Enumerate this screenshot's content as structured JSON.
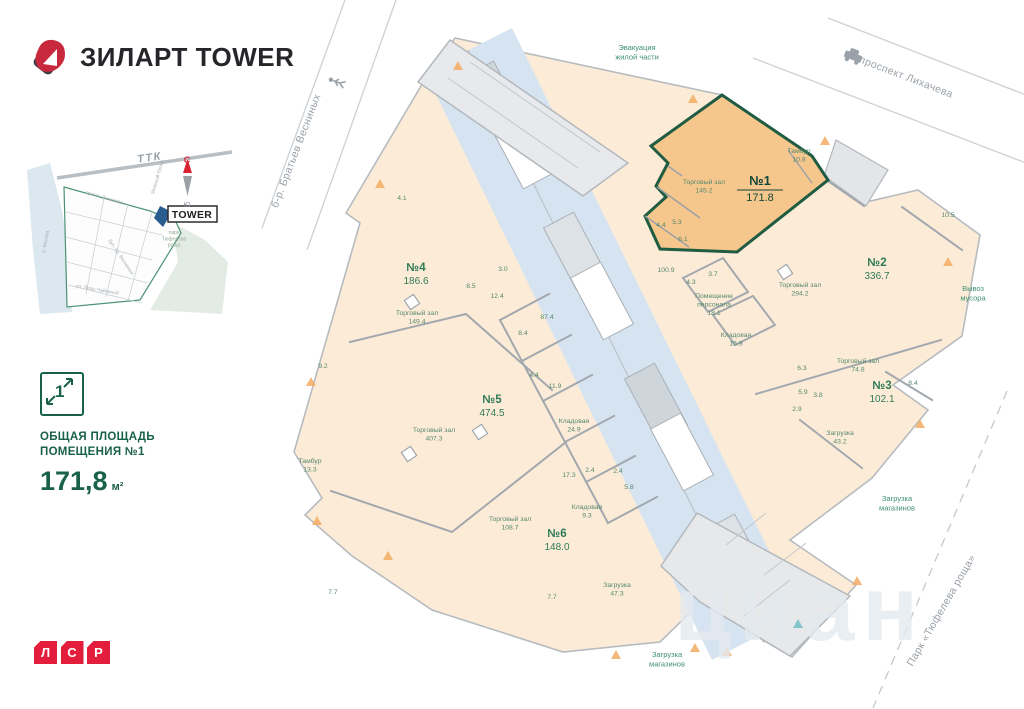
{
  "brand": {
    "logo_text": "ЗИЛАРТ TOWER",
    "developer_letters": [
      "Л",
      "С",
      "Р"
    ]
  },
  "info": {
    "icon_number": "1",
    "title_line1": "ОБЩАЯ ПЛОЩАДЬ",
    "title_line2": "ПОМЕЩЕНИЯ №1",
    "area_value": "171,8",
    "area_unit": "м²"
  },
  "colors": {
    "accent_green": "#1a614c",
    "label_green": "#2e7a57",
    "unit_fill": "#fcecd7",
    "unit1_fill": "#f6c78d",
    "unit1_border": "#1f5c41",
    "core_blue": "#d6e4f1",
    "brand_red": "#e31e3d",
    "compass_red": "#d8232f"
  },
  "watermark": "циан",
  "plan": {
    "labels": [
      {
        "x": 150,
        "y": 161,
        "r": -8,
        "c": "ttk",
        "l": [
          "ТТК"
        ],
        "n": "map-ttk-label"
      },
      {
        "x": 187,
        "y": 163,
        "c": "compass-n",
        "l": [
          "С"
        ],
        "n": "compass-north"
      },
      {
        "x": 187,
        "y": 207,
        "c": "compass-s",
        "l": [
          "Ю"
        ],
        "n": "compass-south"
      },
      {
        "x": 192,
        "y": 218,
        "c": "tower",
        "l": [
          "TOWER"
        ],
        "n": "map-tower-label"
      },
      {
        "x": 47,
        "y": 242,
        "r": -80,
        "c": "map-street",
        "l": [
          "р. Москва"
        ],
        "n": "map-river-label"
      },
      {
        "x": 174,
        "y": 234,
        "c": "map-park",
        "l": [
          "парк",
          "Тюфелева",
          "роща"
        ],
        "n": "map-park-label"
      },
      {
        "x": 104,
        "y": 199,
        "r": 16,
        "c": "map-street",
        "l": [
          "просп. Лихачева"
        ],
        "n": "map-street-label"
      },
      {
        "x": 159,
        "y": 177,
        "r": -74,
        "c": "map-street",
        "l": [
          "Зеленый бульв."
        ],
        "n": "map-street-label"
      },
      {
        "x": 97,
        "y": 291,
        "r": 10,
        "c": "map-street",
        "l": [
          "ул. Лизы Чайкиной"
        ],
        "n": "map-street-label"
      },
      {
        "x": 120,
        "y": 258,
        "r": 56,
        "c": "map-street",
        "l": [
          "бул. бр. Весниных"
        ],
        "n": "map-street-label"
      },
      {
        "x": 905,
        "y": 80,
        "r": 21,
        "c": "street",
        "l": [
          "проспект Лихачева"
        ],
        "n": "street-label"
      },
      {
        "x": 299,
        "y": 152,
        "r": -69,
        "c": "street",
        "l": [
          "б-р. Братьев Весниных"
        ],
        "n": "street-label"
      },
      {
        "x": 944,
        "y": 612,
        "r": -60,
        "c": "street",
        "l": [
          "Парк «Тюфелева роща»"
        ],
        "n": "park-label"
      },
      {
        "x": 637,
        "y": 50,
        "c": "annot",
        "l": [
          "Эвакуация",
          "жилой части"
        ],
        "n": "annotation"
      },
      {
        "x": 973,
        "y": 291,
        "c": "annot",
        "l": [
          "Вывоз",
          "мусора"
        ],
        "n": "annotation"
      },
      {
        "x": 897,
        "y": 501,
        "c": "annot",
        "l": [
          "Загрузка",
          "магазинов"
        ],
        "n": "annotation"
      },
      {
        "x": 667,
        "y": 657,
        "c": "annot",
        "l": [
          "Загрузка",
          "магазинов"
        ],
        "n": "annotation"
      },
      {
        "x": 760,
        "y": 185,
        "c": "unit1",
        "l": [
          "№1"
        ],
        "n": "unit1-number"
      },
      {
        "x": 760,
        "y": 201,
        "c": "u1area",
        "l": [
          "171.8"
        ],
        "n": "unit1-area"
      },
      {
        "x": 416,
        "y": 271,
        "c": "unit",
        "l": [
          "№4"
        ],
        "n": "unit-number"
      },
      {
        "x": 416,
        "y": 284,
        "c": "uarea",
        "l": [
          "186.6"
        ],
        "n": "unit-area"
      },
      {
        "x": 492,
        "y": 403,
        "c": "unit",
        "l": [
          "№5"
        ],
        "n": "unit-number"
      },
      {
        "x": 492,
        "y": 416,
        "c": "uarea",
        "l": [
          "474.5"
        ],
        "n": "unit-area"
      },
      {
        "x": 557,
        "y": 537,
        "c": "unit",
        "l": [
          "№6"
        ],
        "n": "unit-number"
      },
      {
        "x": 557,
        "y": 550,
        "c": "uarea",
        "l": [
          "148.0"
        ],
        "n": "unit-area"
      },
      {
        "x": 877,
        "y": 266,
        "c": "unit",
        "l": [
          "№2"
        ],
        "n": "unit-number"
      },
      {
        "x": 877,
        "y": 279,
        "c": "uarea",
        "l": [
          "336.7"
        ],
        "n": "unit-area"
      },
      {
        "x": 882,
        "y": 389,
        "c": "unit",
        "l": [
          "№3"
        ],
        "n": "unit-number"
      },
      {
        "x": 882,
        "y": 402,
        "c": "uarea",
        "l": [
          "102.1"
        ],
        "n": "unit-area"
      },
      {
        "x": 704,
        "y": 184,
        "c": "room",
        "l": [
          "Торговый зал",
          "145.2"
        ],
        "n": "room-label"
      },
      {
        "x": 799,
        "y": 153,
        "c": "room",
        "l": [
          "Тамбур",
          "10.8"
        ],
        "n": "room-label"
      },
      {
        "x": 661,
        "y": 227,
        "c": "room",
        "l": [
          "4.4"
        ],
        "n": "room-label"
      },
      {
        "x": 677,
        "y": 224,
        "c": "room",
        "l": [
          "5.3"
        ],
        "n": "room-label"
      },
      {
        "x": 683,
        "y": 241,
        "c": "room",
        "l": [
          "6.1"
        ],
        "n": "room-label"
      },
      {
        "x": 417,
        "y": 315,
        "c": "room",
        "l": [
          "Торговый зал",
          "149.4"
        ],
        "n": "room-label"
      },
      {
        "x": 471,
        "y": 288,
        "c": "room",
        "l": [
          "8.5"
        ],
        "n": "room-label"
      },
      {
        "x": 497,
        "y": 298,
        "c": "room",
        "l": [
          "12.4"
        ],
        "n": "room-label"
      },
      {
        "x": 503,
        "y": 271,
        "c": "room",
        "l": [
          "3.0"
        ],
        "n": "room-label"
      },
      {
        "x": 547,
        "y": 319,
        "c": "room",
        "l": [
          "87.4"
        ],
        "n": "room-label"
      },
      {
        "x": 523,
        "y": 335,
        "c": "room",
        "l": [
          "8.4"
        ],
        "n": "room-label"
      },
      {
        "x": 534,
        "y": 377,
        "c": "room",
        "l": [
          "4.4"
        ],
        "n": "room-label"
      },
      {
        "x": 323,
        "y": 368,
        "c": "room",
        "l": [
          "9.2"
        ],
        "n": "room-label"
      },
      {
        "x": 402,
        "y": 200,
        "c": "room",
        "l": [
          "4.1"
        ],
        "n": "room-label"
      },
      {
        "x": 310,
        "y": 463,
        "c": "room",
        "l": [
          "Тамбур",
          "13.3"
        ],
        "n": "room-label"
      },
      {
        "x": 434,
        "y": 432,
        "c": "room",
        "l": [
          "Торговый зал",
          "407.3"
        ],
        "n": "room-label"
      },
      {
        "x": 555,
        "y": 388,
        "c": "room",
        "l": [
          "11.9"
        ],
        "n": "room-label"
      },
      {
        "x": 574,
        "y": 423,
        "c": "room",
        "l": [
          "Кладовая",
          "24.9"
        ],
        "n": "room-label"
      },
      {
        "x": 569,
        "y": 477,
        "c": "room",
        "l": [
          "17.3"
        ],
        "n": "room-label"
      },
      {
        "x": 590,
        "y": 472,
        "c": "room",
        "l": [
          "2.4"
        ],
        "n": "room-label"
      },
      {
        "x": 618,
        "y": 473,
        "c": "room",
        "l": [
          "2.4"
        ],
        "n": "room-label"
      },
      {
        "x": 629,
        "y": 489,
        "c": "room",
        "l": [
          "5.8"
        ],
        "n": "room-label"
      },
      {
        "x": 587,
        "y": 509,
        "c": "room",
        "l": [
          "Кладовая",
          "9.3"
        ],
        "n": "room-label"
      },
      {
        "x": 510,
        "y": 521,
        "c": "room",
        "l": [
          "Торговый зал",
          "108.7"
        ],
        "n": "room-label"
      },
      {
        "x": 552,
        "y": 599,
        "c": "room",
        "l": [
          "7.7"
        ],
        "n": "room-label"
      },
      {
        "x": 333,
        "y": 594,
        "c": "room",
        "l": [
          "7.7"
        ],
        "n": "room-label"
      },
      {
        "x": 617,
        "y": 587,
        "c": "room",
        "l": [
          "Загрузка",
          "47.3"
        ],
        "n": "room-label"
      },
      {
        "x": 666,
        "y": 272,
        "c": "room",
        "l": [
          "100.9"
        ],
        "n": "room-label"
      },
      {
        "x": 691,
        "y": 284,
        "c": "room",
        "l": [
          "4.3"
        ],
        "n": "room-label"
      },
      {
        "x": 713,
        "y": 276,
        "c": "room",
        "l": [
          "3.7"
        ],
        "n": "room-label"
      },
      {
        "x": 714,
        "y": 298,
        "c": "room",
        "l": [
          "Помещение",
          "персонала",
          "18.1"
        ],
        "n": "room-label"
      },
      {
        "x": 736,
        "y": 337,
        "c": "room",
        "l": [
          "Кладовая",
          "15.9"
        ],
        "n": "room-label"
      },
      {
        "x": 800,
        "y": 287,
        "c": "room",
        "l": [
          "Торговый зал",
          "294.2"
        ],
        "n": "room-label"
      },
      {
        "x": 858,
        "y": 363,
        "c": "room",
        "l": [
          "Торговый зал",
          "74.8"
        ],
        "n": "room-label"
      },
      {
        "x": 802,
        "y": 370,
        "c": "room",
        "l": [
          "6.3"
        ],
        "n": "room-label"
      },
      {
        "x": 803,
        "y": 394,
        "c": "room",
        "l": [
          "5.9"
        ],
        "n": "room-label"
      },
      {
        "x": 818,
        "y": 397,
        "c": "room",
        "l": [
          "3.8"
        ],
        "n": "room-label"
      },
      {
        "x": 797,
        "y": 411,
        "c": "room",
        "l": [
          "2.9"
        ],
        "n": "room-label"
      },
      {
        "x": 913,
        "y": 385,
        "c": "room",
        "l": [
          "8.4"
        ],
        "n": "room-label"
      },
      {
        "x": 948,
        "y": 217,
        "c": "room",
        "l": [
          "10.5"
        ],
        "n": "room-label"
      },
      {
        "x": 840,
        "y": 435,
        "c": "room",
        "l": [
          "Загрузка",
          "43.2"
        ],
        "n": "room-label"
      },
      {
        "x": 800,
        "y": 640,
        "c": "wm",
        "l": [
          "циан"
        ],
        "n": "watermark"
      }
    ]
  }
}
